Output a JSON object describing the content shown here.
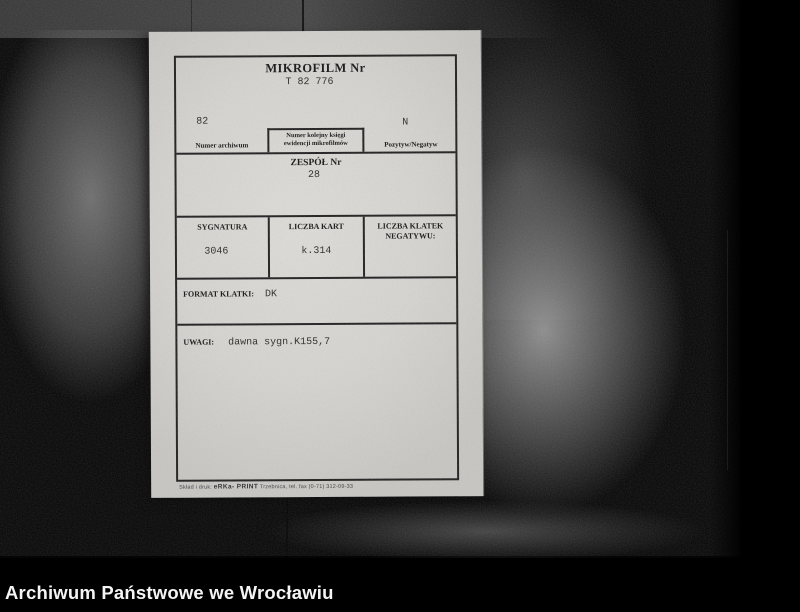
{
  "photo": {
    "caption": "Archiwum Państwowe we Wrocławiu"
  },
  "card": {
    "title": "MIKROFILM Nr",
    "microfilm_number": "T 82 776",
    "archive_number": {
      "value": "82",
      "label": "Numer archiwum"
    },
    "registry_book": {
      "label_line1": "Numer kolejny księgi",
      "label_line2": "ewidencji mikrofilmów"
    },
    "positive_negative": {
      "value": "N",
      "label": "Pozytyw/Negatyw"
    },
    "zespol": {
      "label": "ZESPÓŁ Nr",
      "value": "28"
    },
    "sygnatura": {
      "label": "SYGNATURA",
      "value": "3046"
    },
    "liczba_kart": {
      "label": "LICZBA KART",
      "value": "k.314"
    },
    "liczba_klatek": {
      "label_line1": "LICZBA KLATEK",
      "label_line2": "NEGATYWU:",
      "value": ""
    },
    "format_klatki": {
      "label": "FORMAT KLATKI:",
      "value": "DK"
    },
    "uwagi": {
      "label": "UWAGI:",
      "value": "dawna sygn.K155,7"
    },
    "printer_note": {
      "prefix": "Skład i druk:",
      "brand": "eRKa- PRINT",
      "rest": "Trzebnica, tel. fax (0-71) 312-09-33"
    }
  },
  "colors": {
    "background": "#050505",
    "paper": "#d5d4d0",
    "ink": "#1d1d1d",
    "caption_text": "#f4f4f4"
  }
}
